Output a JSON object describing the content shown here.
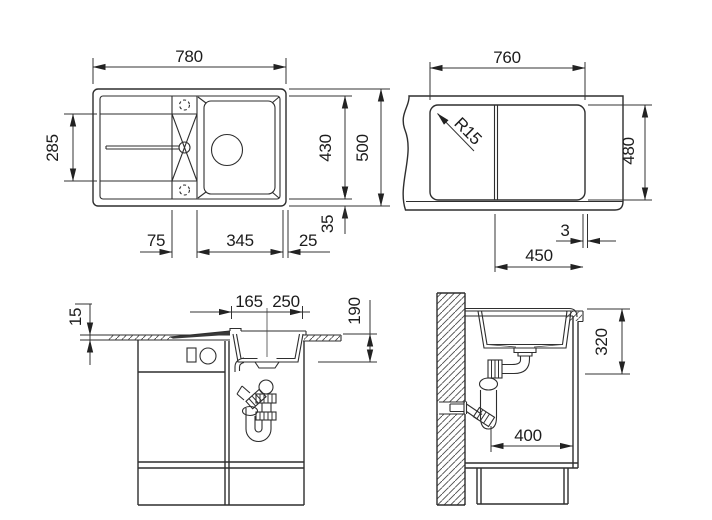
{
  "drawing": {
    "plan": {
      "width": "780",
      "drainboard_depth": "285",
      "bowl_length": "430",
      "overall_depth": "500",
      "rim_offset": "35",
      "tap_ledge": "75",
      "bowl_width": "345",
      "edge": "25"
    },
    "cutout": {
      "width": "760",
      "corner_radius": "R15",
      "height": "480",
      "edge_gap": "3",
      "bowl_span": "450"
    },
    "front": {
      "counter_thickness": "15",
      "drain_offset_left": "165",
      "drain_offset_right": "250",
      "bowl_depth": "190"
    },
    "side": {
      "install_clearance": "320",
      "wall_distance": "400"
    }
  }
}
